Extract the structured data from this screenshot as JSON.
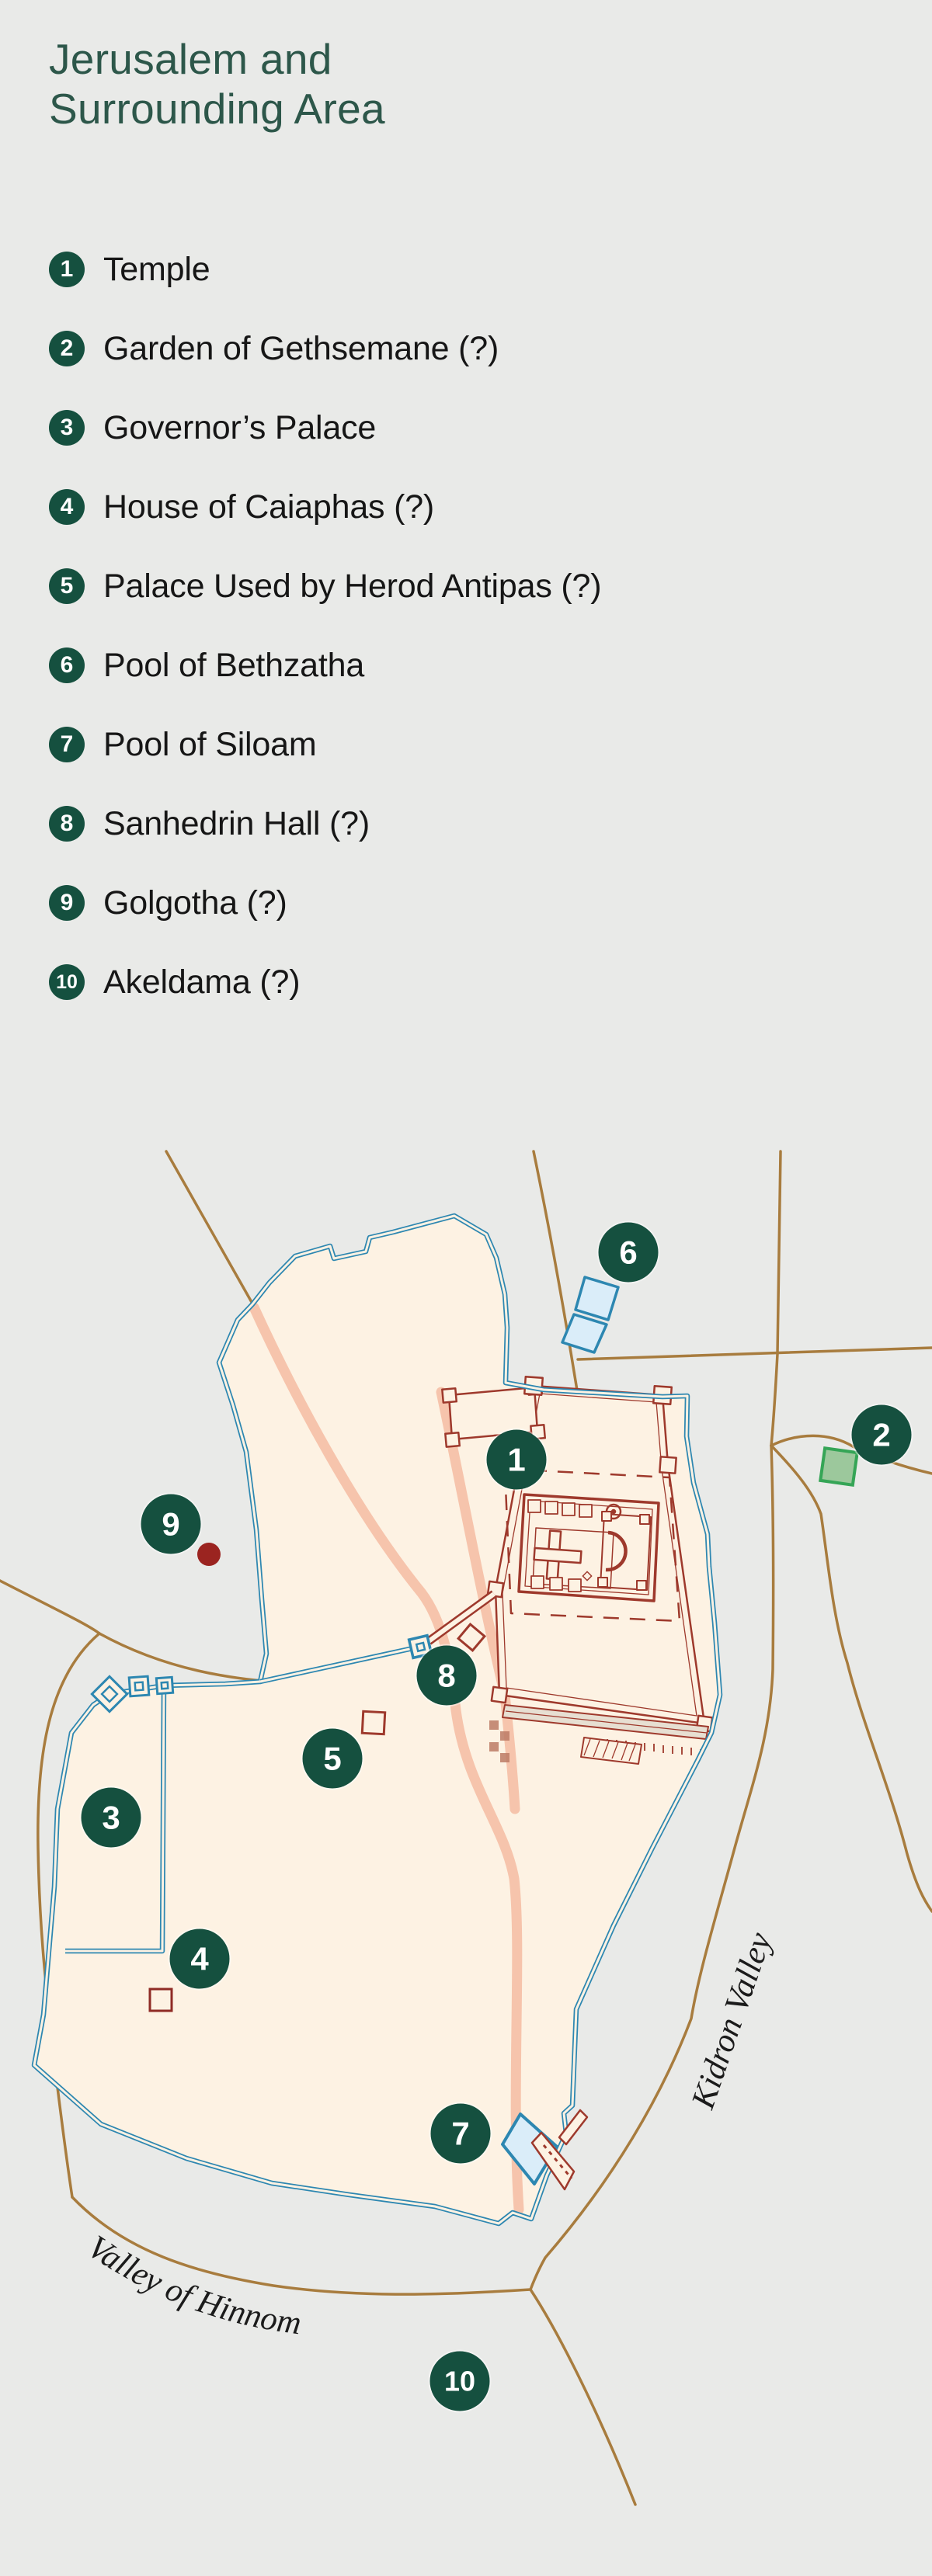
{
  "title": {
    "line1": "Jerusalem and",
    "line2": "Surrounding Area"
  },
  "legend": {
    "items": [
      {
        "n": "1",
        "label": "Temple"
      },
      {
        "n": "2",
        "label": "Garden of Gethsemane (?)"
      },
      {
        "n": "3",
        "label": "Governor’s Palace"
      },
      {
        "n": "4",
        "label": "House of Caiaphas (?)"
      },
      {
        "n": "5",
        "label": "Palace Used by Herod Antipas (?)"
      },
      {
        "n": "6",
        "label": "Pool of Bethzatha"
      },
      {
        "n": "7",
        "label": "Pool of Siloam"
      },
      {
        "n": "8",
        "label": "Sanhedrin Hall (?)"
      },
      {
        "n": "9",
        "label": "Golgotha (?)"
      },
      {
        "n": "10",
        "label": "Akeldama (?)"
      }
    ]
  },
  "map": {
    "labels": {
      "kidron": "Kidron Valley",
      "hinnom": "Valley of Hinnom"
    },
    "markers": [
      {
        "n": "1"
      },
      {
        "n": "2"
      },
      {
        "n": "3"
      },
      {
        "n": "4"
      },
      {
        "n": "5"
      },
      {
        "n": "6"
      },
      {
        "n": "7"
      },
      {
        "n": "8"
      },
      {
        "n": "9"
      },
      {
        "n": "10"
      }
    ],
    "colors": {
      "background": "#e9eae8",
      "marker_green": "#15503f",
      "title_green": "#2d574a",
      "wall_blue": "#2d87b1",
      "city_fill": "#fdf2e3",
      "road_brown": "#a87c3e",
      "street_pink": "#f6c4ac",
      "temple_red": "#9e392c",
      "pool_fill": "#daedf9",
      "garden_green_fill": "#9cc89c",
      "garden_green_stroke": "#35a556",
      "golgotha_red": "#9b2420"
    }
  }
}
